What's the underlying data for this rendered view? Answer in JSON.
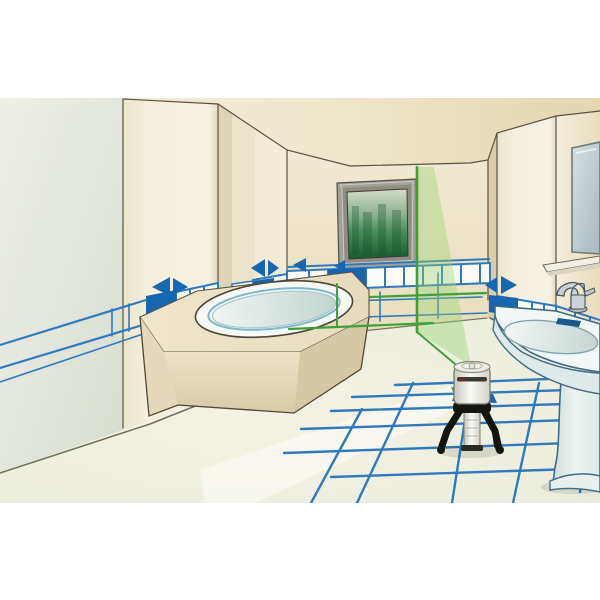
{
  "scene": {
    "kind": "illustration",
    "room": "bathroom",
    "subject": "Cross-line laser level on mini tripod projecting green tile-alignment lines",
    "objects": [
      "ceiling",
      "left-wall",
      "back-wall",
      "right-wall",
      "pillars",
      "window-with-forest-view",
      "bathtub-with-beige-surround",
      "blue-tile-wainscot-band",
      "blue-alignment-arrows",
      "blue-layout-lines-walls",
      "blue-floor-grid-lines",
      "green-laser-vertical-line",
      "green-laser-horizontal-line",
      "green-laser-fan-plane",
      "laser-level-device",
      "mini-tripod",
      "pedestal-sink",
      "chrome-faucet",
      "shelf",
      "mirror"
    ]
  },
  "palette": {
    "paper_white": "#ffffff",
    "ceiling_light": "#f5f0de",
    "ceiling_dark": "#e3d6b0",
    "back_wall_top": "#f2ecd6",
    "back_wall_bottom": "#e9ddbd",
    "left_wall_light": "#eef0e8",
    "left_wall_dark": "#d7ddd1",
    "pillar_face": "#f4efdc",
    "pillar_side": "#dcd2b2",
    "floor_light": "#f5f2e4",
    "floor_shadow": "#dfe5d8",
    "outline_dark": "#5a5244",
    "tile_blue": "#1766b0",
    "line_blue": "#2f7abc",
    "laser_green": "#3ea03a",
    "laser_fan_rgba": "rgba(150,210,110,0.38)",
    "window_frame": "#a3a197",
    "window_view_top": "#d3dcc9",
    "window_view_mid": "#4c8f5b",
    "window_view_bottom": "#175c2b",
    "fixture_white": "#f2f7f5",
    "fixture_shade": "#c6d6d2",
    "fixture_line": "#3f6c85",
    "chrome": "#ccd3d6",
    "tripod_black": "#151510",
    "device_body": "#f1efe8",
    "tub_rim_blue": "#7fb9c9"
  }
}
